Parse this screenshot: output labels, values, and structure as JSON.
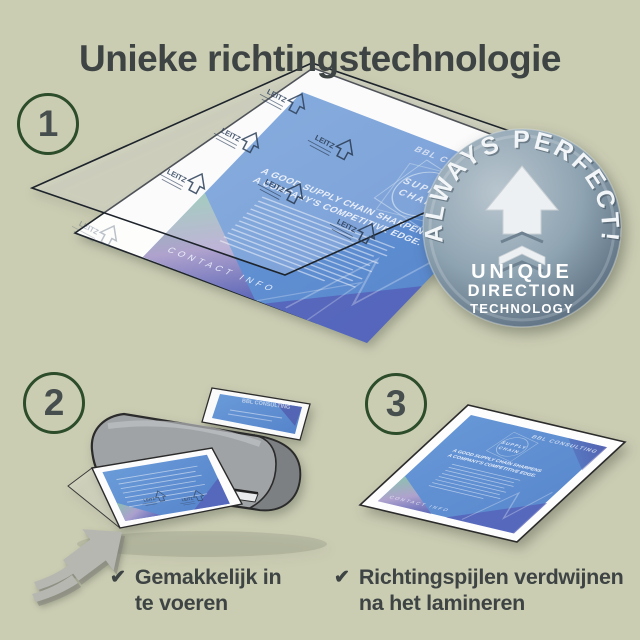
{
  "title": "Unieke richtingstechnologie",
  "steps": [
    {
      "number": "1"
    },
    {
      "number": "2"
    },
    {
      "number": "3"
    }
  ],
  "badge": {
    "arc_text": "ALWAYS PERFECT!",
    "line1": "UNIQUE",
    "line2": "DIRECTION",
    "line3": "TECHNOLOGY",
    "icon": "up-arrow-with-chevrons"
  },
  "flyer": {
    "brand": "BBL CONSULTING",
    "emblem_line1": "SUPPLY",
    "emblem_line2": "CHAIN",
    "headline_line1": "A GOOD SUPPLY CHAIN SHARPENS",
    "headline_line2": "A COMPANY'S COMPETITIVE EDGE.",
    "footer": "CONTACT INFO"
  },
  "pouch": {
    "print_brand": "LEITZ",
    "print_icon": "direction-arrow-outline"
  },
  "checklist": [
    {
      "line1": "Gemakkelijk in",
      "line2": "te voeren"
    },
    {
      "line1": "Richtingspijlen verdwijnen",
      "line2": "na het lamineren"
    }
  ],
  "icons": {
    "check": "✔",
    "feed_arrow": "up-right-arrow-with-chevrons"
  },
  "colors": {
    "background": "#cbcdb3",
    "heading_text": "#3d4443",
    "step_circle_border": "#2c4c2a",
    "flyer_blue": "#5e92d5",
    "flyer_indigo": "#5560b8",
    "flyer_teal": "#8fc3ad",
    "badge_light": "#c2cdd4",
    "badge_dark": "#55687a",
    "machine_grey": "#9ea1a4",
    "pouch_print_navy": "#32455f"
  }
}
